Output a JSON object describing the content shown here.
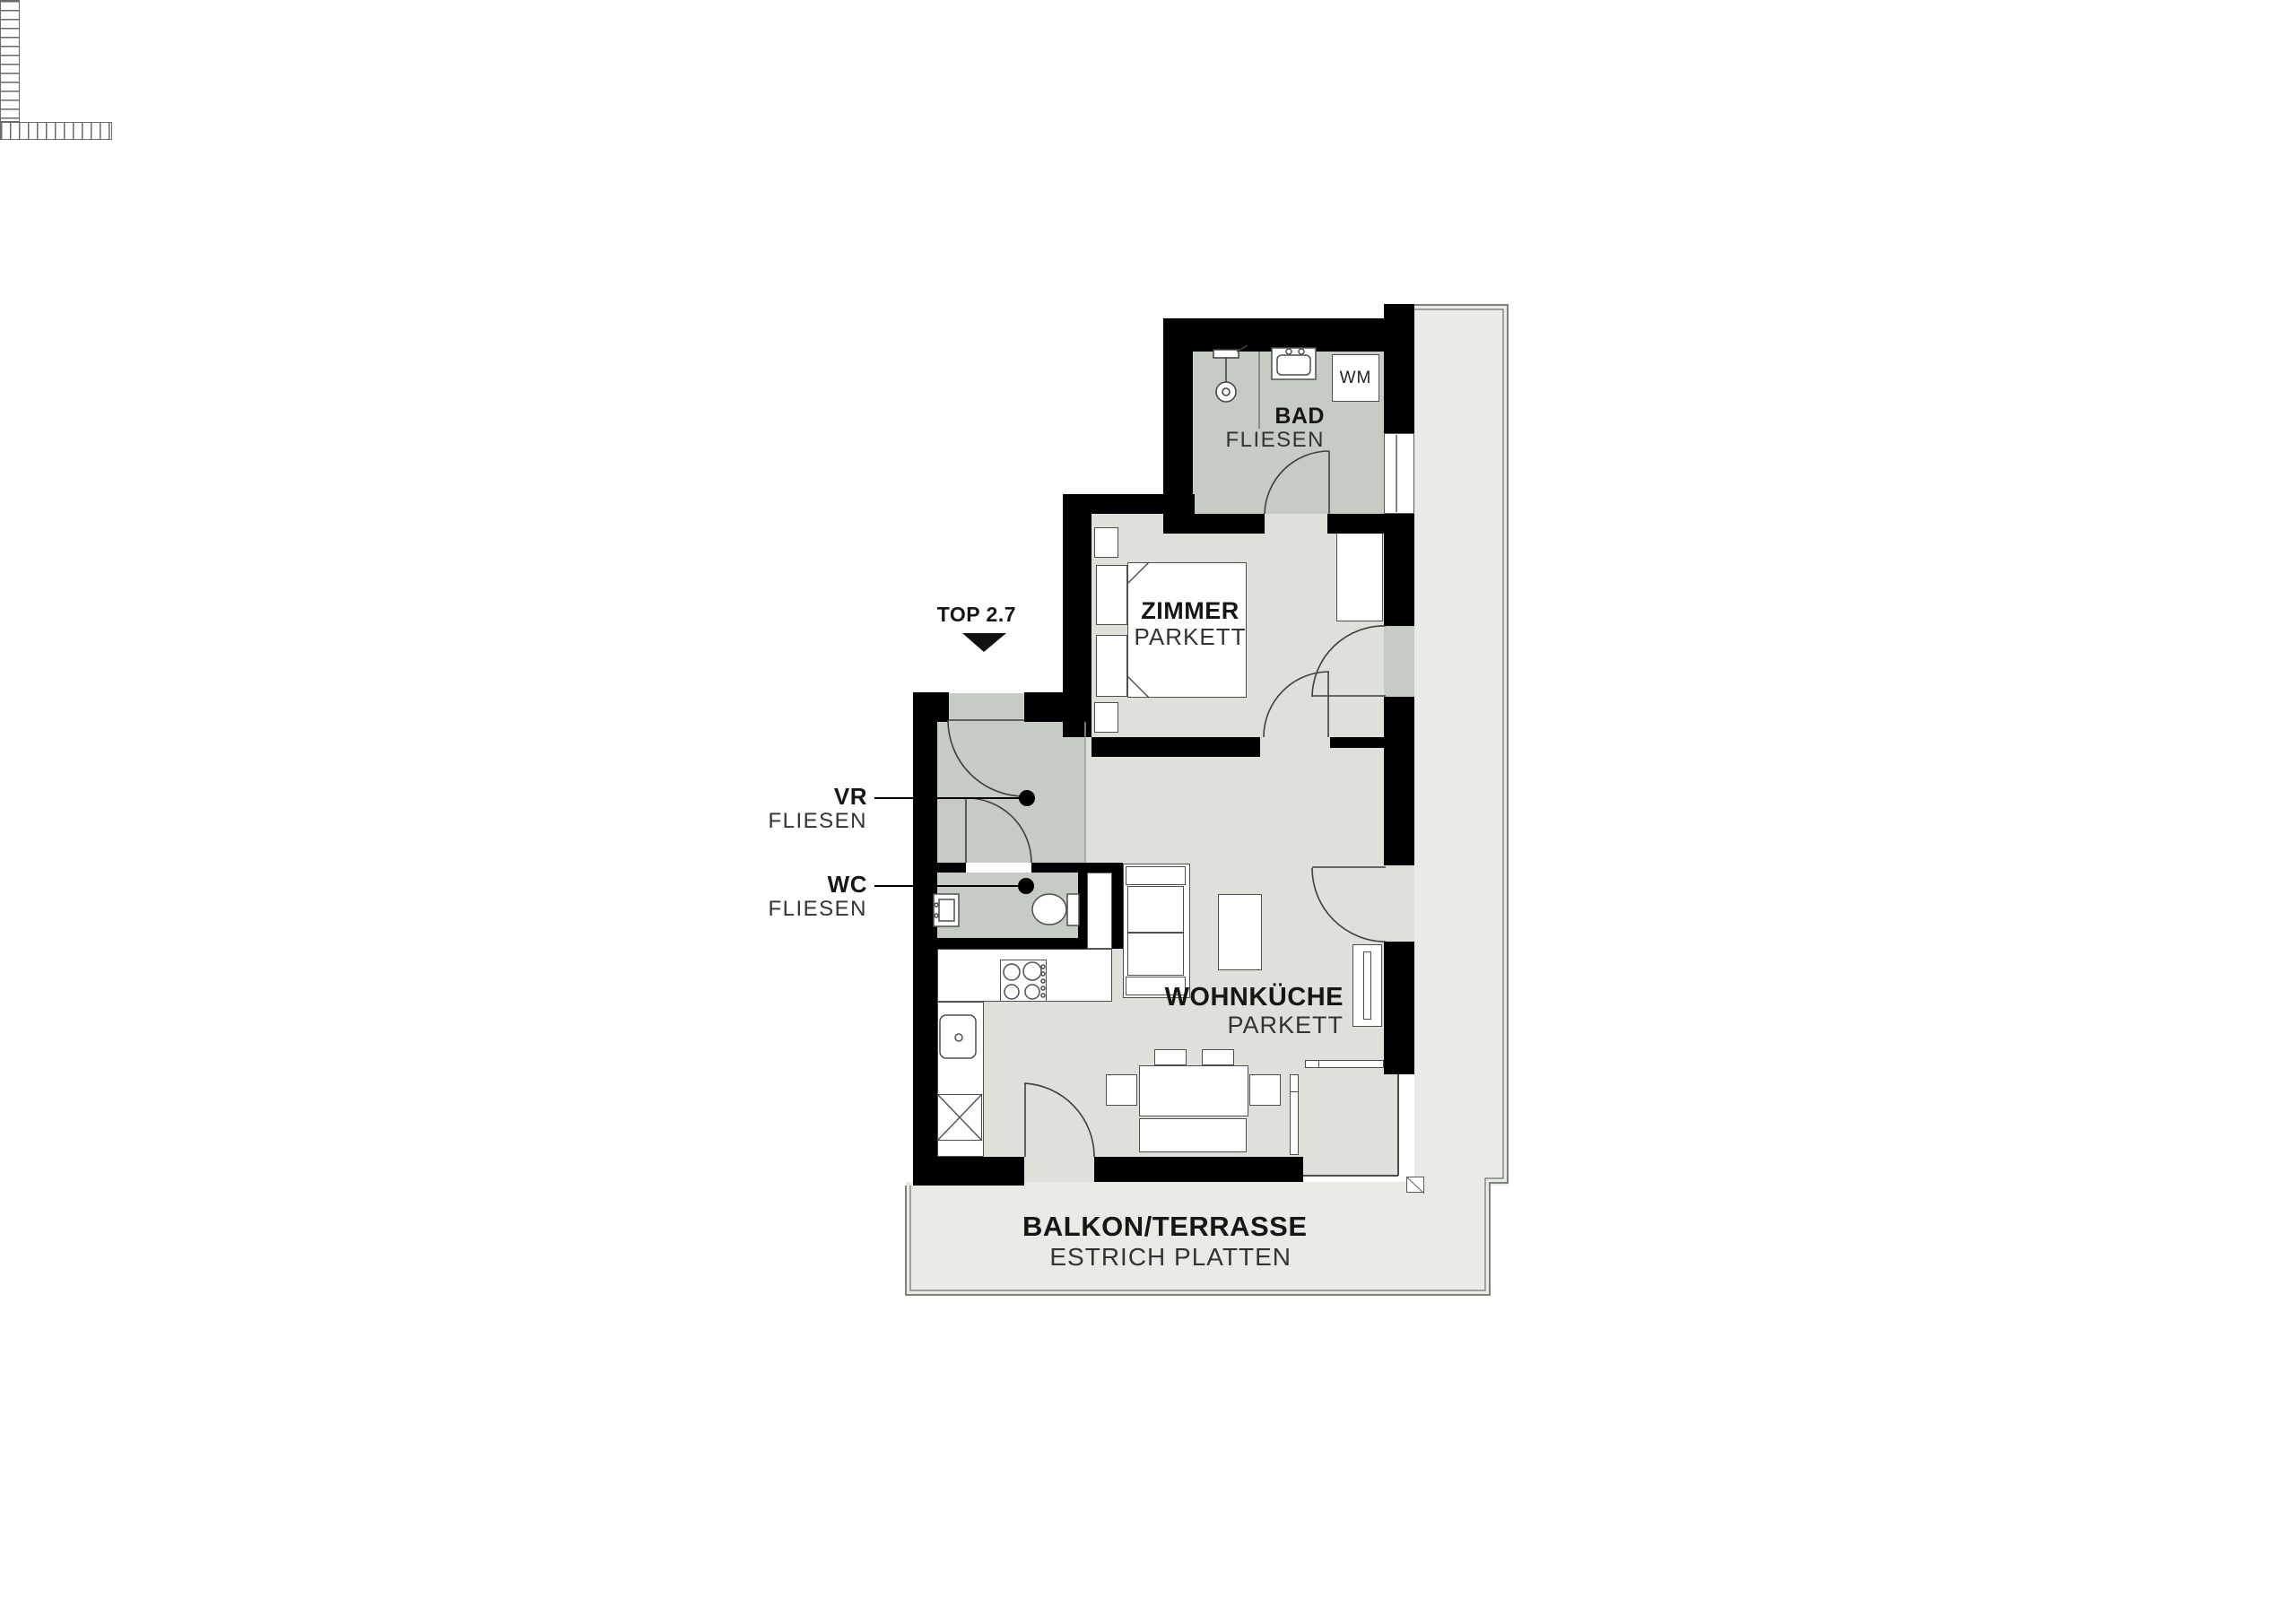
{
  "unit": {
    "label": "TOP 2.7"
  },
  "rooms": {
    "bad": {
      "name": "BAD",
      "finish": "FLIESEN"
    },
    "zimmer": {
      "name": "ZIMMER",
      "finish": "PARKETT"
    },
    "vr": {
      "name": "VR",
      "finish": "FLIESEN"
    },
    "wc": {
      "name": "WC",
      "finish": "FLIESEN"
    },
    "wohnkueche": {
      "name": "WOHNKÜCHE",
      "finish": "PARKETT"
    },
    "balkon": {
      "name": "BALKON/TERRASSE",
      "finish": "ESTRICH PLATTEN"
    }
  },
  "appliances": {
    "washing_machine": "WM"
  },
  "colors": {
    "wall": "#000000",
    "tile_floor": "#c6cbc3",
    "parquet_floor": "#dde1da",
    "terrace_floor": "#e9ebe6",
    "outline": "#4f4f4f"
  }
}
